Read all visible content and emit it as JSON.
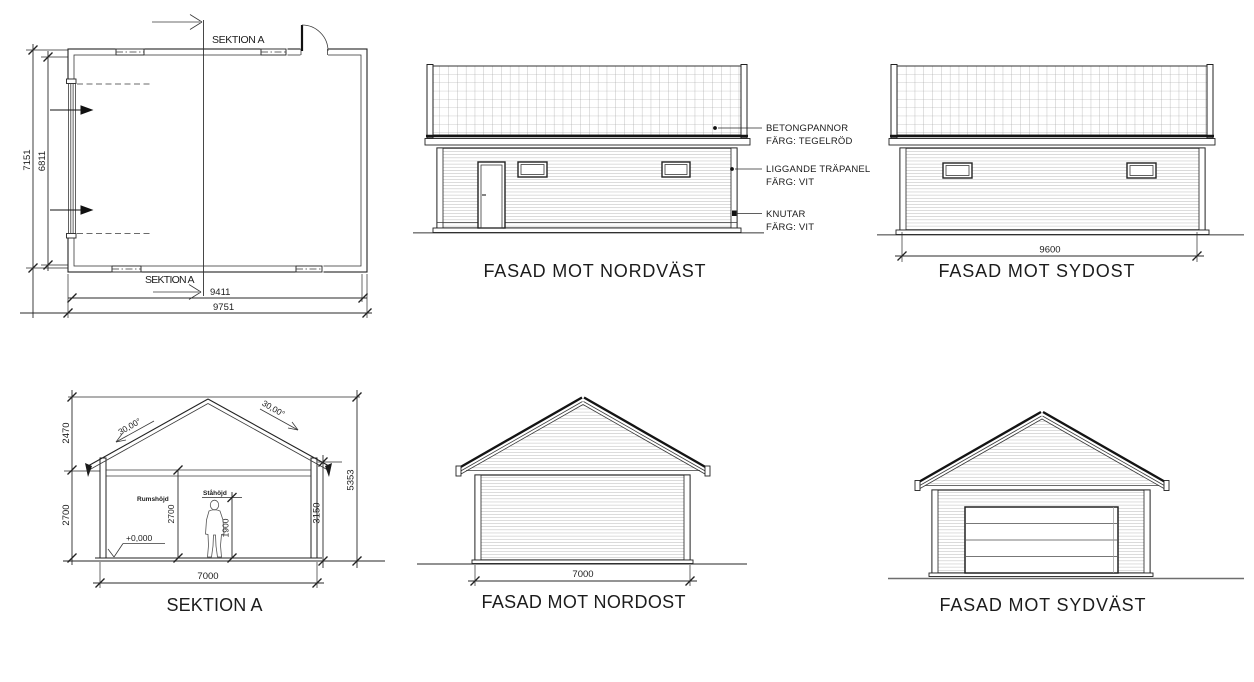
{
  "palette": {
    "line": "#222222",
    "hatch": "#9b9b9b",
    "ground": "#6e6e6e",
    "background": "#ffffff"
  },
  "floor_plan": {
    "section_label_top": "SEKTION A",
    "section_label_bottom": "SEKTION A",
    "dim_height_outer": "7151",
    "dim_height_inner": "6811",
    "dim_width_inner": "9411",
    "dim_width_outer": "9751"
  },
  "facade_nordvast": {
    "title": "FASAD MOT NORDVÄST",
    "callouts": [
      {
        "line1": "BETONGPANNOR",
        "line2": "FÄRG: TEGELRÖD"
      },
      {
        "line1": "LIGGANDE TRÄPANEL",
        "line2": "FÄRG: VIT"
      },
      {
        "line1": "KNUTAR",
        "line2": "FÄRG: VIT"
      }
    ]
  },
  "facade_sydost": {
    "title": "FASAD MOT SYDOST",
    "dim_width": "9600"
  },
  "section_a": {
    "title": "SEKTION A",
    "dim_roof_rise": "2470",
    "dim_wall_height": "2700",
    "roof_angle_left": "30,00°",
    "roof_angle_right": "30,00°",
    "dim_total_height": "5353",
    "dim_eave_height": "3150",
    "room_height_label": "Rumshöjd",
    "room_height_value": "2700",
    "stand_height_label": "Ståhöjd",
    "stand_height_value": "1900",
    "level_marker": "+0,000",
    "dim_width": "7000"
  },
  "facade_nordost": {
    "title": "FASAD MOT NORDOST",
    "dim_width": "7000"
  },
  "facade_sydvast": {
    "title": "FASAD MOT SYDVÄST"
  }
}
